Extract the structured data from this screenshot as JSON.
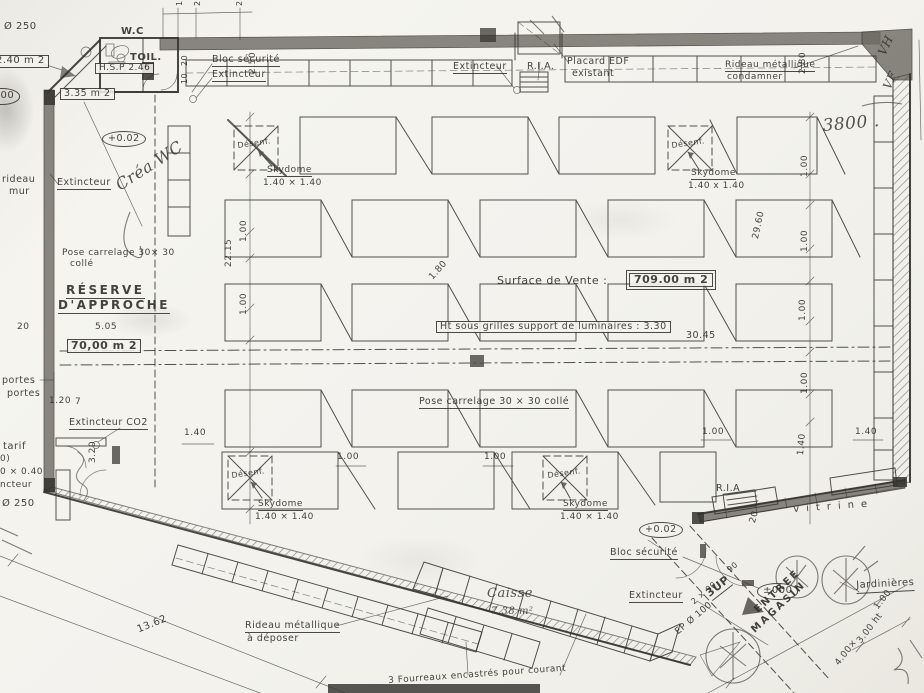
{
  "document_kind": "scanned retail store floor plan",
  "key_figures": {
    "sales_area": "709.00 m 2",
    "reserve_area": "70,00 m 2",
    "ceiling_height_note": "Ht  sous grilles  support  de  luminaires :  3.30"
  },
  "labels": [
    {
      "n": "dia-250-top",
      "t": "Ø 250",
      "x": 4,
      "y": 22,
      "s": 10
    },
    {
      "n": "area-2-40-box",
      "t": "2.40 m 2",
      "x": -8,
      "y": 55,
      "s": 10,
      "cls": "boxed"
    },
    {
      "n": "level-circle-left",
      "t": "0.00",
      "x": -16,
      "y": 88,
      "s": 10,
      "cls": "circled"
    },
    {
      "n": "wc-label",
      "t": "W.C",
      "x": 121,
      "y": 27,
      "s": 10,
      "cls": "big"
    },
    {
      "n": "toil-label",
      "t": "TOIL.",
      "x": 130,
      "y": 53,
      "s": 10,
      "cls": "big"
    },
    {
      "n": "hsp-box",
      "t": "H.S.P 2.46",
      "x": 95,
      "y": 63,
      "s": 9,
      "cls": "boxed"
    },
    {
      "n": "area-3-35-box",
      "t": "3.35 m 2",
      "x": 60,
      "y": 88,
      "s": 9.5,
      "cls": "boxed"
    },
    {
      "n": "tick-10-top",
      "t": "10",
      "x": 176,
      "y": 6,
      "s": 8,
      "r": -90
    },
    {
      "n": "tick-20-top-a",
      "t": "20",
      "x": 194,
      "y": 6,
      "s": 8,
      "r": -90
    },
    {
      "n": "tick-20-top-b",
      "t": "20",
      "x": 236,
      "y": 6,
      "s": 8,
      "r": -90
    },
    {
      "n": "bloc-securite-top",
      "t": "Bloc  sécurité",
      "x": 212,
      "y": 55,
      "s": 9.5,
      "cls": "ul"
    },
    {
      "n": "extincteur-top-left",
      "t": "Extincteur",
      "x": 212,
      "y": 70,
      "s": 9.5,
      "cls": "ul"
    },
    {
      "n": "tick-20-leader",
      "t": "20",
      "x": 181,
      "y": 66,
      "s": 8,
      "r": -90
    },
    {
      "n": "tick-10-leader",
      "t": "10",
      "x": 181,
      "y": 84,
      "s": 8,
      "r": -90
    },
    {
      "n": "dim-2-50",
      "t": "2.50",
      "x": 249,
      "y": 74,
      "s": 9,
      "r": -90
    },
    {
      "n": "extincteur-top-mid",
      "t": "Extincteur",
      "x": 453,
      "y": 62,
      "s": 9.5,
      "cls": "ul"
    },
    {
      "n": "ria-top",
      "t": "R.I.A.",
      "x": 527,
      "y": 62,
      "s": 9.5
    },
    {
      "n": "placard-edf-line1",
      "t": "Placard   EDF",
      "x": 567,
      "y": 57,
      "s": 9.5
    },
    {
      "n": "placard-edf-line2",
      "t": "existant",
      "x": 572,
      "y": 69,
      "s": 9.5
    },
    {
      "n": "rideau-condamner-line1",
      "t": "Rideau  métallique",
      "x": 725,
      "y": 61,
      "s": 9,
      "cls": "ul"
    },
    {
      "n": "rideau-condamner-line2",
      "t": "condamner",
      "x": 727,
      "y": 73,
      "s": 9
    },
    {
      "n": "dim-2-80-top",
      "t": "2.80",
      "x": 799,
      "y": 74,
      "s": 9,
      "r": -90
    },
    {
      "n": "hand-3800",
      "t": "3800 .",
      "x": 822,
      "y": 118,
      "s": 17,
      "r": -5,
      "cls": "hand"
    },
    {
      "n": "hand-vh",
      "t": "VH",
      "x": 876,
      "y": 52,
      "s": 12,
      "r": -65,
      "cls": "hand"
    },
    {
      "n": "hand-vf",
      "t": "VF",
      "x": 881,
      "y": 86,
      "s": 12,
      "r": -65,
      "cls": "hand"
    },
    {
      "n": "level-0-02-top",
      "t": "+0.02",
      "x": 102,
      "y": 131,
      "s": 9.5,
      "cls": "circled"
    },
    {
      "n": "rideau-mur-line1",
      "t": "rideau",
      "x": 2,
      "y": 175,
      "s": 9.5
    },
    {
      "n": "rideau-mur-line2",
      "t": "mur",
      "x": 9,
      "y": 187,
      "s": 9.5
    },
    {
      "n": "extincteur-left",
      "t": "Extincteur",
      "x": 57,
      "y": 178,
      "s": 9.5,
      "cls": "ul"
    },
    {
      "n": "hand-crea-wc",
      "t": "Créa WC",
      "x": 113,
      "y": 180,
      "s": 16,
      "r": -33,
      "cls": "hand"
    },
    {
      "n": "desenf-top-left",
      "t": "Désenf.",
      "x": 237,
      "y": 142,
      "s": 8,
      "r": -8
    },
    {
      "n": "skydome-top-left-name",
      "t": "Skydome",
      "x": 267,
      "y": 166,
      "s": 9,
      "cls": "ul"
    },
    {
      "n": "skydome-top-left-size",
      "t": "1.40 × 1.40",
      "x": 263,
      "y": 179,
      "s": 9
    },
    {
      "n": "desenf-top-right",
      "t": "Désenf.",
      "x": 671,
      "y": 142,
      "s": 8,
      "r": -8
    },
    {
      "n": "skydome-top-right-name",
      "t": "Skydome",
      "x": 691,
      "y": 169,
      "s": 9,
      "cls": "ul"
    },
    {
      "n": "skydome-top-right-size",
      "t": "1.40 x 1.40",
      "x": 688,
      "y": 182,
      "s": 9
    },
    {
      "n": "dim-1-00-left-1",
      "t": "1.00",
      "x": 240,
      "y": 242,
      "s": 9,
      "r": -90
    },
    {
      "n": "dim-22-15",
      "t": "22.15",
      "x": 225,
      "y": 267,
      "s": 9,
      "r": -90
    },
    {
      "n": "dim-1-00-left-2",
      "t": "1.00",
      "x": 240,
      "y": 315,
      "s": 9,
      "r": -90
    },
    {
      "n": "dim-29-60",
      "t": "29.60",
      "x": 752,
      "y": 238,
      "s": 9,
      "r": -78
    },
    {
      "n": "dim-1-00-right-1",
      "t": "1.00",
      "x": 801,
      "y": 177,
      "s": 9,
      "r": -90
    },
    {
      "n": "dim-1-00-right-2",
      "t": "1.00",
      "x": 801,
      "y": 252,
      "s": 9,
      "r": -90
    },
    {
      "n": "dim-1-00-right-3",
      "t": "1.00",
      "x": 799,
      "y": 321,
      "s": 9,
      "r": -90
    },
    {
      "n": "dim-1-00-right-4",
      "t": "1.00",
      "x": 801,
      "y": 394,
      "s": 9,
      "r": -90
    },
    {
      "n": "pose-carrelage-left-line1",
      "t": "Pose  carrelage  30× 30",
      "x": 62,
      "y": 249,
      "s": 9
    },
    {
      "n": "pose-carrelage-left-line2",
      "t": "collé",
      "x": 70,
      "y": 260,
      "s": 9
    },
    {
      "n": "reserve-line1",
      "t": "RÉSERVE",
      "x": 66,
      "y": 284,
      "s": 12,
      "cls": "ul ls"
    },
    {
      "n": "reserve-line2",
      "t": "D'APPROCHE",
      "x": 58,
      "y": 299,
      "s": 12,
      "cls": "ul ls"
    },
    {
      "n": "dim-20-left",
      "t": "20",
      "x": 17,
      "y": 323,
      "s": 9
    },
    {
      "n": "dim-5-05",
      "t": "5.05",
      "x": 95,
      "y": 323,
      "s": 9
    },
    {
      "n": "area-70-box",
      "t": "70,00 m 2",
      "x": 67,
      "y": 339,
      "s": 11,
      "cls": "boxed big"
    },
    {
      "n": "dim-1-80",
      "t": "1.80",
      "x": 428,
      "y": 276,
      "s": 9,
      "r": -48
    },
    {
      "n": "surface-vente-label",
      "t": "Surface  de  Vente  :",
      "x": 497,
      "y": 275,
      "s": 11
    },
    {
      "n": "surface-vente-value",
      "t": "709.00 m 2",
      "x": 629,
      "y": 273,
      "s": 11,
      "cls": "boxed2 big"
    },
    {
      "n": "ht-grilles-box",
      "t": "Ht  sous grilles  support  de  luminaires :  3.30",
      "x": 436,
      "y": 321,
      "s": 9.5,
      "cls": "boxed"
    },
    {
      "n": "dim-30-45",
      "t": "30.45",
      "x": 686,
      "y": 331,
      "s": 9.5
    },
    {
      "n": "pose-carrelage-center",
      "t": "Pose  carrelage  30 × 30  collé",
      "x": 419,
      "y": 397,
      "s": 9.5,
      "cls": "ul"
    },
    {
      "n": "portes-line1",
      "t": "portes",
      "x": 2,
      "y": 376,
      "s": 9.5
    },
    {
      "n": "portes-line2",
      "t": "portes",
      "x": 7,
      "y": 389,
      "s": 9.5
    },
    {
      "n": "dim-1-20",
      "t": "1.20",
      "x": 49,
      "y": 397,
      "s": 9
    },
    {
      "n": "dim-7",
      "t": "7",
      "x": 75,
      "y": 398,
      "s": 9
    },
    {
      "n": "extincteur-co2",
      "t": "Extincteur  CO2",
      "x": 69,
      "y": 418,
      "s": 9.5,
      "cls": "ul"
    },
    {
      "n": "tarif-clipped",
      "t": "tarif",
      "x": 3,
      "y": 442,
      "s": 10
    },
    {
      "n": "clipped-paren",
      "t": "0)",
      "x": 0,
      "y": 455,
      "s": 9
    },
    {
      "n": "clipped-0-40",
      "t": "0 × 0.40",
      "x": 0,
      "y": 468,
      "s": 9
    },
    {
      "n": "clipped-ncteur",
      "t": "ncteur",
      "x": 0,
      "y": 481,
      "s": 9
    },
    {
      "n": "dia-250-bottom",
      "t": "Ø 250",
      "x": 2,
      "y": 499,
      "s": 10
    },
    {
      "n": "dim-3-20",
      "t": "3.20",
      "x": 89,
      "y": 463,
      "s": 9,
      "r": -90
    },
    {
      "n": "dim-1-40-left",
      "t": "1.40",
      "x": 184,
      "y": 429,
      "s": 9
    },
    {
      "n": "dim-1-00-center-1",
      "t": "1.00",
      "x": 337,
      "y": 453,
      "s": 9
    },
    {
      "n": "dim-1-00-center-2",
      "t": "1.00",
      "x": 484,
      "y": 453,
      "s": 9
    },
    {
      "n": "dim-1-00-center-3",
      "t": "1.00",
      "x": 702,
      "y": 428,
      "s": 9
    },
    {
      "n": "dim-1-40-right",
      "t": "1.40",
      "x": 855,
      "y": 428,
      "s": 9
    },
    {
      "n": "desenf-bottom-left",
      "t": "Désenf.",
      "x": 231,
      "y": 472,
      "s": 8,
      "r": -8
    },
    {
      "n": "skydome-bottom-left-name",
      "t": "Skydome",
      "x": 258,
      "y": 500,
      "s": 9,
      "cls": "ul"
    },
    {
      "n": "skydome-bottom-left-size",
      "t": "1.40 × 1.40",
      "x": 255,
      "y": 513,
      "s": 9
    },
    {
      "n": "desenf-bottom-center",
      "t": "Désenf.",
      "x": 547,
      "y": 472,
      "s": 8,
      "r": -8
    },
    {
      "n": "skydome-bottom-center-name",
      "t": "Skydome",
      "x": 563,
      "y": 500,
      "s": 9,
      "cls": "ul"
    },
    {
      "n": "skydome-bottom-center-size",
      "t": "1.40 × 1.40",
      "x": 560,
      "y": 513,
      "s": 9
    },
    {
      "n": "level-0-02-bottom",
      "t": "+0.02",
      "x": 639,
      "y": 522,
      "s": 9.5,
      "cls": "circled"
    },
    {
      "n": "bloc-securite-bottom",
      "t": "Bloc  sécurité",
      "x": 610,
      "y": 548,
      "s": 9.5,
      "cls": "ul"
    },
    {
      "n": "extincteur-bottom",
      "t": "Extincteur",
      "x": 629,
      "y": 591,
      "s": 9.5,
      "cls": "ul"
    },
    {
      "n": "ria-bottom",
      "t": "R.I.A",
      "x": 716,
      "y": 484,
      "s": 9.5
    },
    {
      "n": "vitrine",
      "t": "vitrine",
      "x": 793,
      "y": 505,
      "s": 10,
      "r": -4,
      "cls": "sp"
    },
    {
      "n": "dim-20-vitrine",
      "t": "20",
      "x": 749,
      "y": 522,
      "s": 9,
      "r": -75
    },
    {
      "n": "dim-1-40-vitrine",
      "t": "1.40",
      "x": 797,
      "y": 455,
      "s": 9,
      "r": -85
    },
    {
      "n": "caisse-name",
      "t": "Caisse",
      "x": 487,
      "y": 587,
      "s": 13,
      "cls": "hand"
    },
    {
      "n": "caisse-area",
      "t": "7.38 m²",
      "x": 491,
      "y": 607,
      "s": 10,
      "cls": "hand"
    },
    {
      "n": "level-000-entrance",
      "t": "±000",
      "x": 757,
      "y": 583,
      "s": 10,
      "cls": "circled"
    },
    {
      "n": "steps-3up",
      "t": "3UP",
      "x": 704,
      "y": 590,
      "s": 11,
      "r": -38,
      "cls": "ul big"
    },
    {
      "n": "entree-line1",
      "t": "ENTREE",
      "x": 753,
      "y": 608,
      "s": 10,
      "r": -43,
      "cls": "ls"
    },
    {
      "n": "entree-line2",
      "t": "MAGASIN",
      "x": 750,
      "y": 628,
      "s": 10,
      "r": -43,
      "cls": "ls"
    },
    {
      "n": "ep-100",
      "t": "EP Ø 100",
      "x": 674,
      "y": 630,
      "s": 9,
      "r": -40
    },
    {
      "n": "dim-90",
      "t": "90",
      "x": 726,
      "y": 568,
      "s": 8,
      "r": -40
    },
    {
      "n": "dim-2x90",
      "t": "2 × 90",
      "x": 690,
      "y": 600,
      "s": 8,
      "r": -40
    },
    {
      "n": "jardinieres",
      "t": "Jardinières",
      "x": 856,
      "y": 581,
      "s": 10,
      "r": -3,
      "cls": "ul"
    },
    {
      "n": "dim-1-00-jardinieres",
      "t": "1.00",
      "x": 873,
      "y": 606,
      "s": 9,
      "r": -52
    },
    {
      "n": "dim-4-00",
      "t": "4.00×",
      "x": 834,
      "y": 662,
      "s": 9,
      "r": -52
    },
    {
      "n": "dim-3-00-ht",
      "t": "3.00 ht",
      "x": 856,
      "y": 640,
      "s": 9,
      "r": -52
    },
    {
      "n": "rideau-deposer-line1",
      "t": "Rideau  métallique",
      "x": 245,
      "y": 621,
      "s": 9.5,
      "cls": "ul"
    },
    {
      "n": "rideau-deposer-line2",
      "t": "à  déposer",
      "x": 247,
      "y": 634,
      "s": 9.5
    },
    {
      "n": "dim-13-62",
      "t": "13.62",
      "x": 136,
      "y": 626,
      "s": 10,
      "r": -22
    },
    {
      "n": "fourreaux-note",
      "t": "3  Fourreaux  encastrés  pour  courant",
      "x": 388,
      "y": 677,
      "s": 9,
      "r": -4
    }
  ]
}
